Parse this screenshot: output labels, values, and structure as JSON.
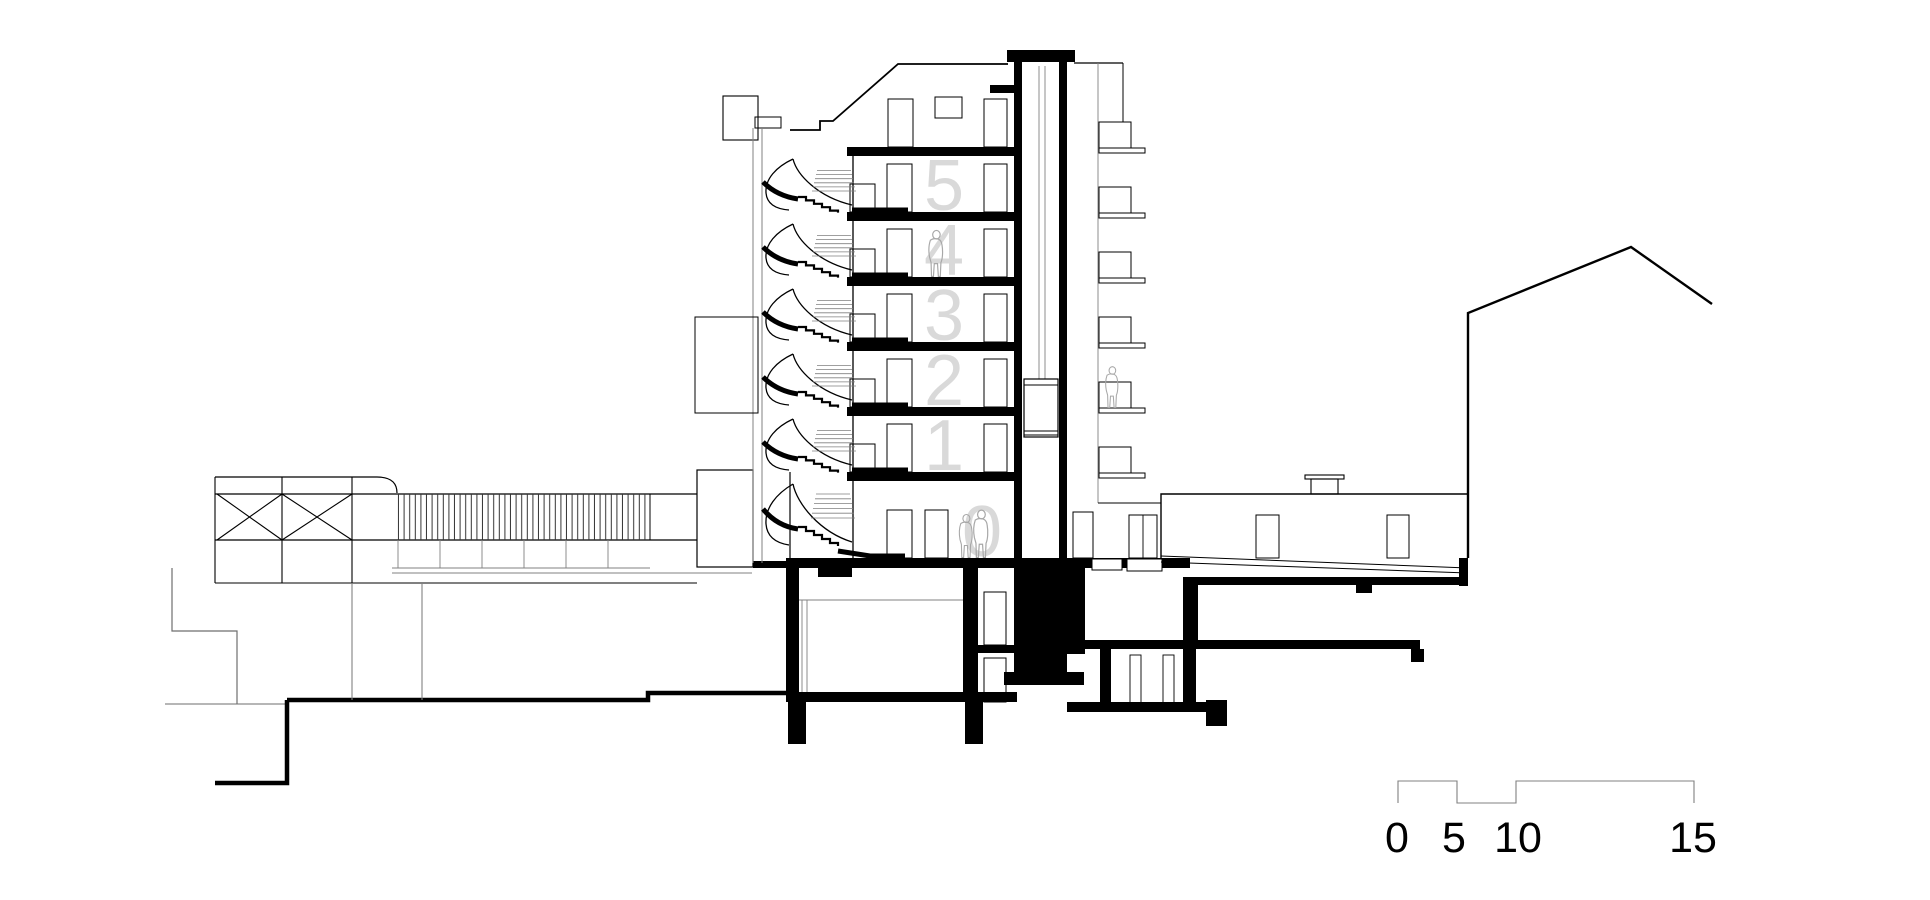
{
  "drawing": {
    "type": "architectural-section",
    "floor_labels": [
      "5",
      "4",
      "3",
      "2",
      "1",
      "0"
    ],
    "scale_bar": {
      "labels": [
        "0",
        "5",
        "10",
        "15"
      ]
    },
    "colors": {
      "ink": "#000000",
      "gray": "#808080",
      "terrain": "#6e6e6e",
      "floor_number": "#d9d9d9",
      "figure": "#a8a8a8",
      "background": "#ffffff"
    }
  }
}
